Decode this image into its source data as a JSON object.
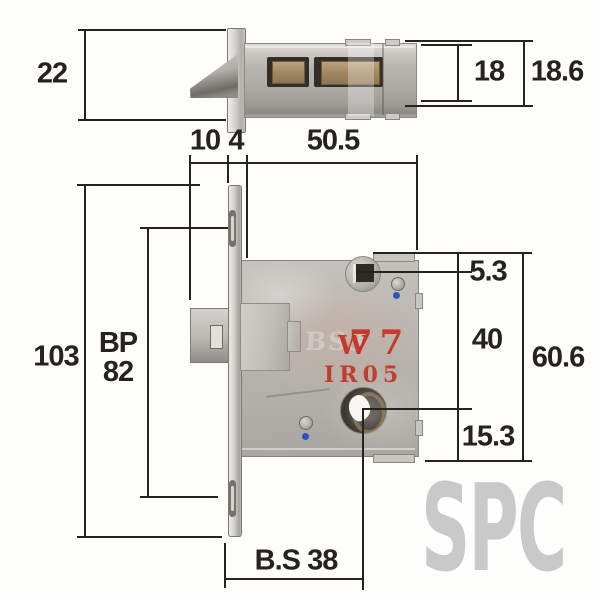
{
  "watermark_text": "SPC",
  "lock_stamp": {
    "overlay_letter": "W",
    "model_number": "77",
    "code": "IR05",
    "embossed_text": "BS3"
  },
  "dims": {
    "plate_width": "22",
    "case_inner_height": "18",
    "case_outer_height": "18.6",
    "latch_projection": "10",
    "plate_thickness": "4",
    "case_depth": "50.5",
    "plate_height": "103",
    "bp_label": "BP",
    "bp_value": "82",
    "top_offset": "5.3",
    "hole_pitch": "40",
    "case_height": "60.6",
    "bottom_offset": "15.3",
    "backset": "B.S 38"
  },
  "colors": {
    "dimension_line": "#27221e",
    "stamp_red": "#c43024",
    "dot_blue": "#2d54c0",
    "watermark_gray": "#c9c9c9",
    "brass": "#a18a62"
  }
}
